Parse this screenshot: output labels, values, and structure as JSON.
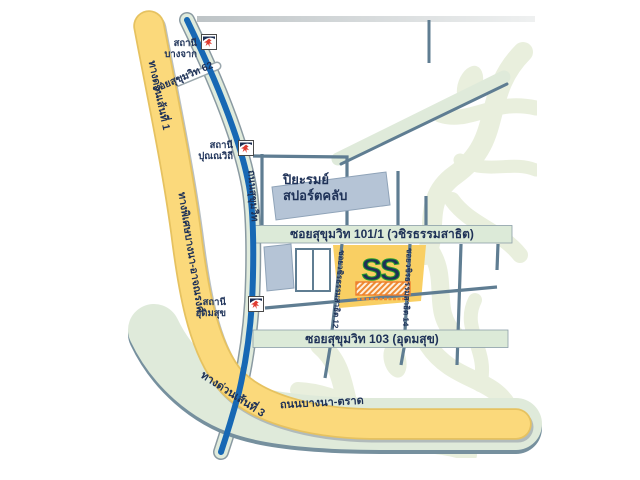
{
  "map": {
    "roads": {
      "expressway1_label": "ทางด่วนเส้นที่ 1",
      "expressway_bangna_atnarong_label": "ทางพิเศษบางนา-อาจณรงค์",
      "expressway3_label": "ทางด่วนเส้นที่ 3",
      "bangna_trad_label": "ถนนบางนา-ตราด",
      "sukhumvit_label": "ถนนสุขุมวิท",
      "soi62_label": "ซอยสุขุมวิท 62",
      "soi101_label": "ซอยสุขุมวิท 101/1 (วชิรธรรมสาธิต)",
      "soi103_label": "ซอยสุขุมวิท 103 (อุดมสุข)",
      "soi_wachiratham12_label": "ซอยวชิรธรรมสาธิต 12",
      "soi_wachiratham14_label": "ซอยวชิรธรรมสาธิต 14"
    },
    "stations": [
      {
        "line1": "สถานี",
        "line2": "บางจาก"
      },
      {
        "line1": "สถานี",
        "line2": "ปุณณวิถี"
      },
      {
        "line1": "สถานี",
        "line2": "อุดมสุข"
      }
    ],
    "places": {
      "sports_club_line1": "ปิยะรมย์",
      "sports_club_line2": "สปอร์ตคลับ",
      "logo_text": "SS"
    },
    "colors": {
      "expressway_yellow": "#fbd97b",
      "bts_blue": "#1768b4",
      "road_green": "#dfeada",
      "road_line_slate": "#5f7d92",
      "building_fill": "#b5c4d6",
      "label_navy": "#1e3157",
      "logo_green": "#2ba12b",
      "logo_orange": "#ee7f2d",
      "landmark_yellow": "#f9cf63",
      "foliage_green": "#e9efdd"
    }
  }
}
